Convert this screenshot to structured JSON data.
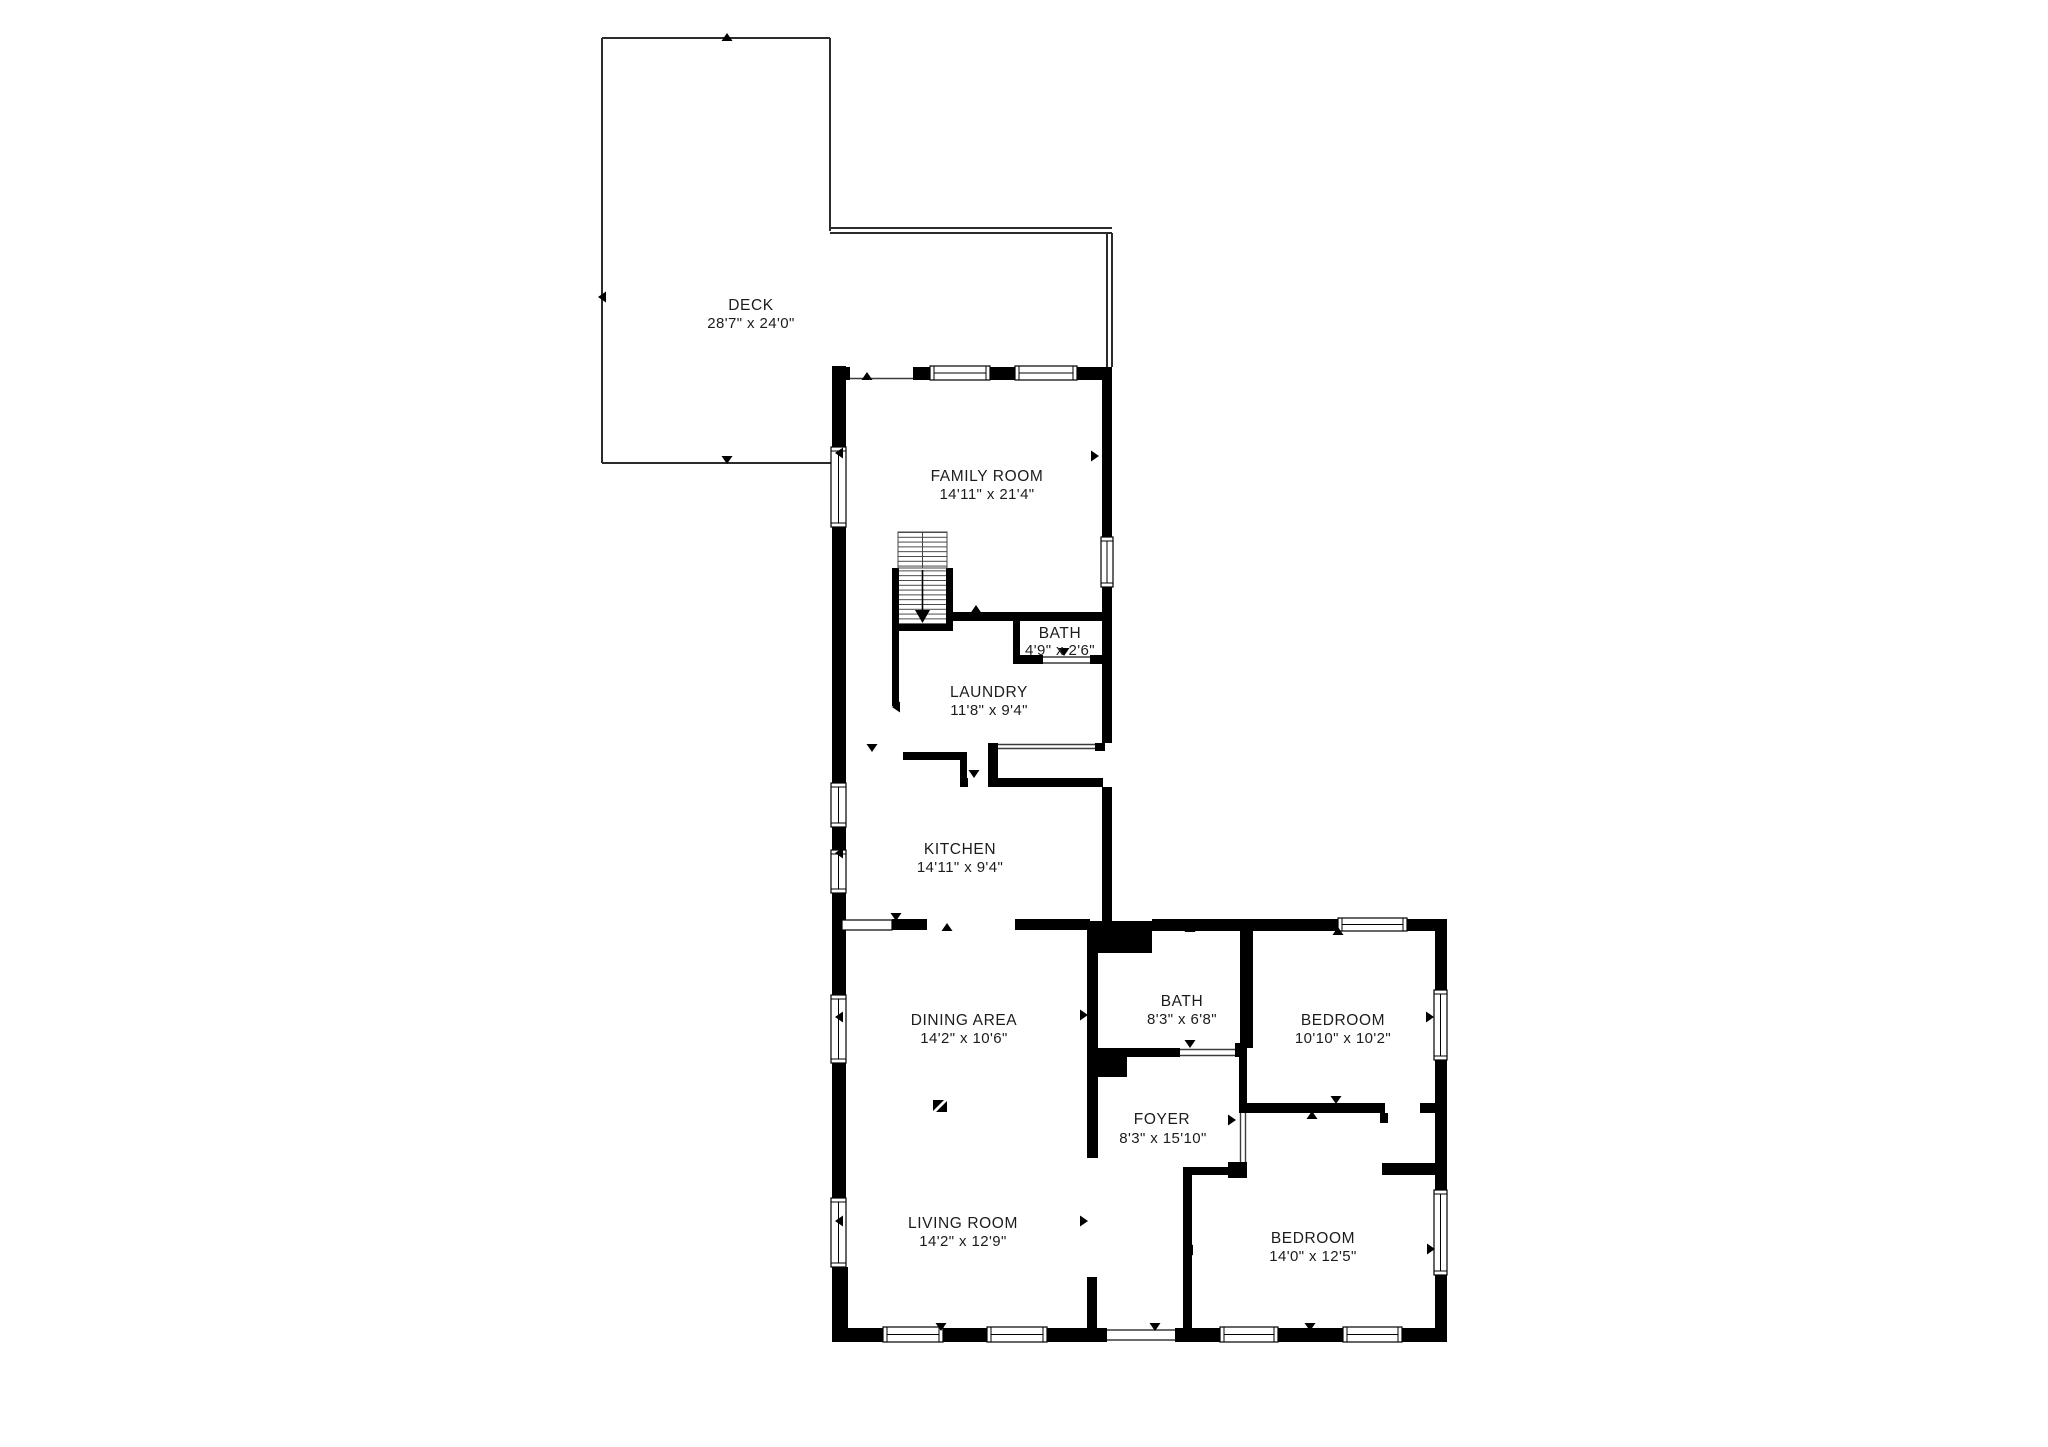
{
  "floorplan": {
    "colors": {
      "background": "#ffffff",
      "walls": "#000000",
      "deck_outline": "#2b2b2b",
      "text": "#1c1c1c"
    },
    "rooms": [
      {
        "id": "deck",
        "name": "DECK",
        "dims": "28'7\" x 24'0\""
      },
      {
        "id": "family-room",
        "name": "FAMILY ROOM",
        "dims": "14'11\" x 21'4\""
      },
      {
        "id": "bath-upper",
        "name": "BATH",
        "dims": "4'9\" x 2'6\""
      },
      {
        "id": "laundry",
        "name": "LAUNDRY",
        "dims": "11'8\" x 9'4\""
      },
      {
        "id": "kitchen",
        "name": "KITCHEN",
        "dims": "14'11\" x 9'4\""
      },
      {
        "id": "dining-area",
        "name": "DINING AREA",
        "dims": "14'2\" x 10'6\""
      },
      {
        "id": "bath-main",
        "name": "BATH",
        "dims": "8'3\" x 6'8\""
      },
      {
        "id": "bedroom-1",
        "name": "BEDROOM",
        "dims": "10'10\" x 10'2\""
      },
      {
        "id": "foyer",
        "name": "FOYER",
        "dims": "8'3\" x 15'10\""
      },
      {
        "id": "living-room",
        "name": "LIVING ROOM",
        "dims": "14'2\" x 12'9\""
      },
      {
        "id": "bedroom-2",
        "name": "BEDROOM",
        "dims": "14'0\" x 12'5\""
      }
    ]
  }
}
